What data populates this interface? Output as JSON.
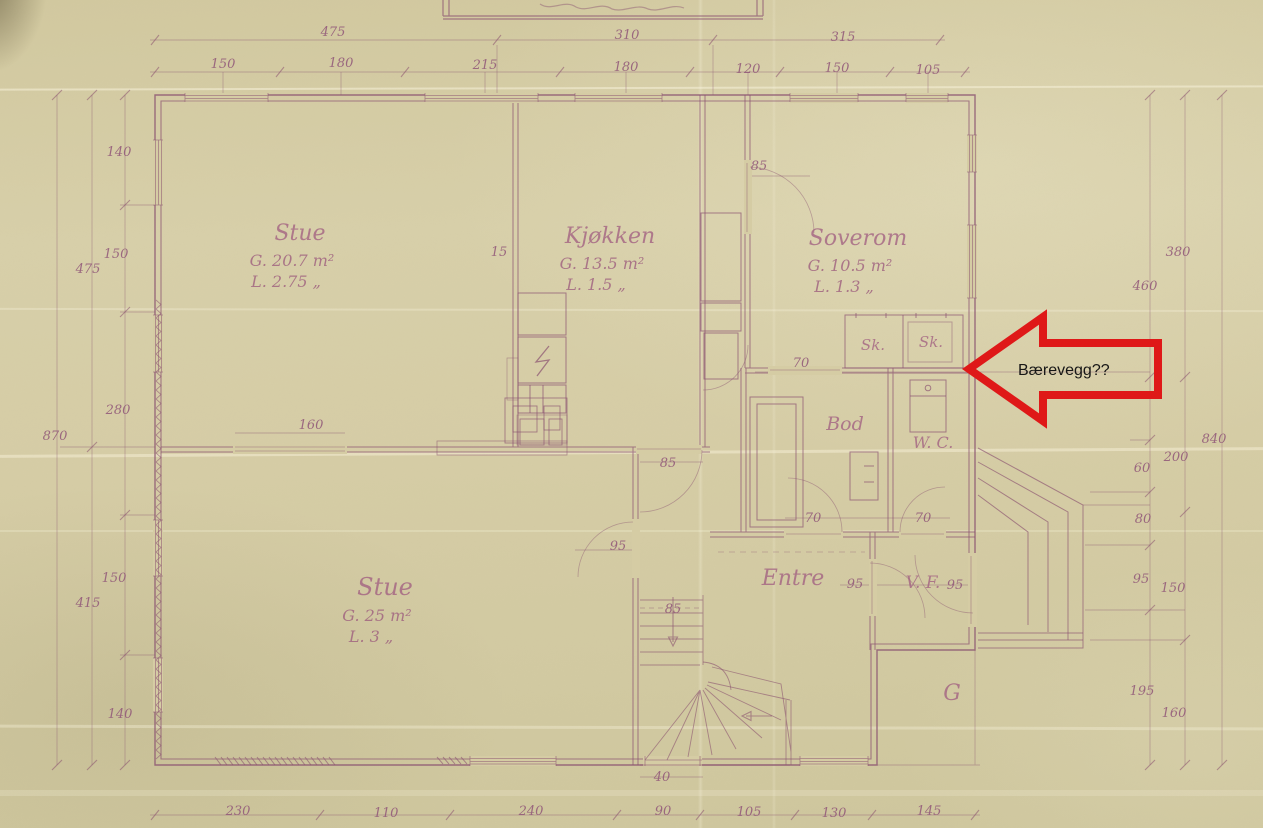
{
  "document": {
    "type": "scanned hand-drawn floor plan",
    "language": "Norwegian"
  },
  "palette": {
    "paper": "#d6cda5",
    "ink": "#8a5170",
    "arrow_red": "#e01717",
    "annotation_text": "#151515"
  },
  "annotation": {
    "label": "Bærevegg??"
  },
  "room_labels": [
    {
      "name": "Stue",
      "area": "G. 20.7 m²",
      "light": "L. 2.75 „",
      "x": 300,
      "y": 240,
      "fs": 22
    },
    {
      "name": "Kjøkken",
      "area": "G. 13.5 m²",
      "light": "L. 1.5 „",
      "x": 610,
      "y": 243,
      "fs": 22
    },
    {
      "name": "Soverom",
      "area": "G. 10.5 m²",
      "light": "L. 1.3 „",
      "x": 858,
      "y": 245,
      "fs": 22
    },
    {
      "name": "Stue",
      "area": "G. 25 m²",
      "light": "L. 3 „",
      "x": 385,
      "y": 595,
      "fs": 24
    },
    {
      "name": "Entre",
      "x": 793,
      "y": 585,
      "fs": 22
    },
    {
      "name": "Bod",
      "x": 845,
      "y": 430,
      "fs": 19
    },
    {
      "name": "W. C.",
      "x": 933,
      "y": 448,
      "fs": 16
    },
    {
      "name": "V. F.",
      "x": 923,
      "y": 588,
      "fs": 17
    },
    {
      "name": "Sk.",
      "x": 873,
      "y": 350,
      "fs": 15
    },
    {
      "name": "Sk.",
      "x": 931,
      "y": 347,
      "fs": 15
    },
    {
      "name": "G",
      "x": 952,
      "y": 700,
      "fs": 22
    }
  ],
  "dimension_labels": [
    {
      "t": "475",
      "x": 333,
      "y": 36
    },
    {
      "t": "310",
      "x": 627,
      "y": 39
    },
    {
      "t": "315",
      "x": 843,
      "y": 41
    },
    {
      "t": "150",
      "x": 223,
      "y": 68
    },
    {
      "t": "180",
      "x": 341,
      "y": 67
    },
    {
      "t": "215",
      "x": 485,
      "y": 69
    },
    {
      "t": "180",
      "x": 626,
      "y": 71
    },
    {
      "t": "120",
      "x": 748,
      "y": 73
    },
    {
      "t": "150",
      "x": 837,
      "y": 72
    },
    {
      "t": "105",
      "x": 928,
      "y": 74
    },
    {
      "t": "140",
      "x": 119,
      "y": 156
    },
    {
      "t": "150",
      "x": 116,
      "y": 258
    },
    {
      "t": "475",
      "x": 88,
      "y": 273
    },
    {
      "t": "280",
      "x": 118,
      "y": 414
    },
    {
      "t": "870",
      "x": 55,
      "y": 440
    },
    {
      "t": "150",
      "x": 114,
      "y": 582
    },
    {
      "t": "415",
      "x": 88,
      "y": 607
    },
    {
      "t": "140",
      "x": 120,
      "y": 718
    },
    {
      "t": "380",
      "x": 1178,
      "y": 256
    },
    {
      "t": "460",
      "x": 1145,
      "y": 290
    },
    {
      "t": "840",
      "x": 1214,
      "y": 443
    },
    {
      "t": "200",
      "x": 1176,
      "y": 461
    },
    {
      "t": "60",
      "x": 1142,
      "y": 472
    },
    {
      "t": "80",
      "x": 1143,
      "y": 523
    },
    {
      "t": "95",
      "x": 1141,
      "y": 583
    },
    {
      "t": "150",
      "x": 1173,
      "y": 592
    },
    {
      "t": "195",
      "x": 1142,
      "y": 695
    },
    {
      "t": "160",
      "x": 1174,
      "y": 717
    },
    {
      "t": "230",
      "x": 238,
      "y": 815
    },
    {
      "t": "110",
      "x": 386,
      "y": 817
    },
    {
      "t": "240",
      "x": 531,
      "y": 815
    },
    {
      "t": "90",
      "x": 663,
      "y": 815
    },
    {
      "t": "105",
      "x": 749,
      "y": 816
    },
    {
      "t": "130",
      "x": 834,
      "y": 817
    },
    {
      "t": "145",
      "x": 929,
      "y": 815
    },
    {
      "t": "160",
      "x": 311,
      "y": 429
    },
    {
      "t": "15",
      "x": 499,
      "y": 256
    },
    {
      "t": "85",
      "x": 759,
      "y": 170
    },
    {
      "t": "70",
      "x": 801,
      "y": 367
    },
    {
      "t": "70",
      "x": 813,
      "y": 522
    },
    {
      "t": "70",
      "x": 923,
      "y": 522
    },
    {
      "t": "95",
      "x": 618,
      "y": 550
    },
    {
      "t": "95",
      "x": 855,
      "y": 588
    },
    {
      "t": "95",
      "x": 955,
      "y": 589
    },
    {
      "t": "85",
      "x": 668,
      "y": 467
    },
    {
      "t": "85",
      "x": 673,
      "y": 613
    },
    {
      "t": "40",
      "x": 662,
      "y": 781
    }
  ]
}
